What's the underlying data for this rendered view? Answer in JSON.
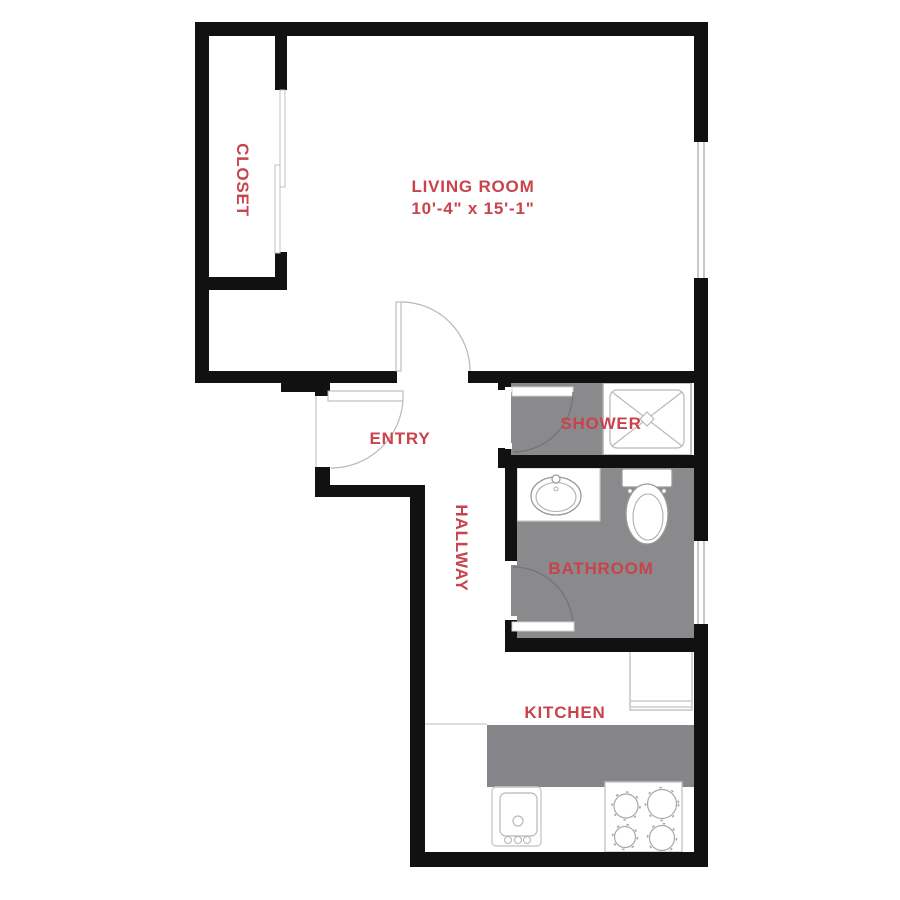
{
  "plan": {
    "type": "apartment-floor-plan",
    "colors": {
      "wall": "#111111",
      "floor_gray": "#8a8a8d",
      "counter_gray": "#85858a",
      "label_red": "#c8434c",
      "fixture_line": "#b0b0b0",
      "background": "#ffffff"
    }
  },
  "rooms": {
    "closet": {
      "label": "CLOSET"
    },
    "living_room": {
      "label": "LIVING ROOM",
      "dimensions": "10'-4\" x 15'-1\""
    },
    "entry": {
      "label": "ENTRY"
    },
    "shower": {
      "label": "SHOWER"
    },
    "hallway": {
      "label": "HALLWAY"
    },
    "bathroom": {
      "label": "BATHROOM"
    },
    "kitchen": {
      "label": "KITCHEN"
    }
  },
  "fixtures": [
    "shower-pan",
    "bathroom-sink-vanity",
    "toilet",
    "kitchen-sink",
    "stove-burners",
    "refrigerator"
  ],
  "doors": [
    "closet-sliding-door",
    "living-room-door",
    "entry-door",
    "shower-door",
    "bathroom-door"
  ],
  "windows": [
    "living-room-window",
    "bathroom-window"
  ]
}
